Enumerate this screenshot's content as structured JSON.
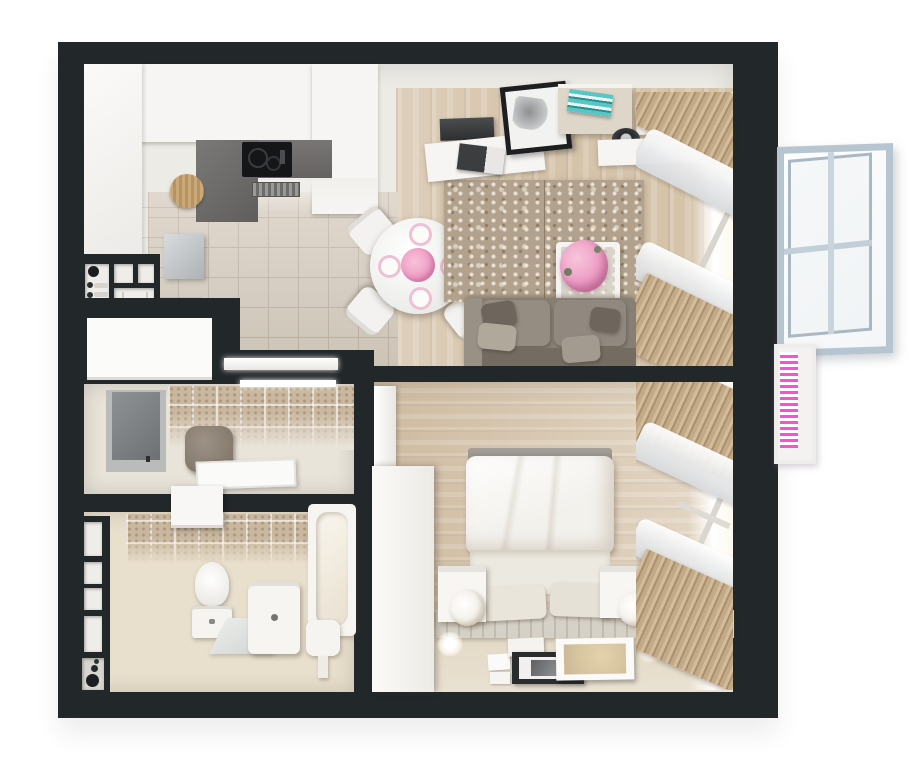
{
  "scene": {
    "type": "3d-floor-plan",
    "subject": "one-bedroom apartment, top-down 3D render",
    "background": "#ffffff",
    "wall_color": "#22272a"
  },
  "palette": {
    "wall": "#22272a",
    "wood_floor": "#d6c4ab",
    "tile_floor": "#d8cec1",
    "bath_floor": "#e9dfcd",
    "hall_floor": "#e9e4da",
    "wall_face": "#edebe6",
    "counter_gray": "#6d6c6a",
    "cooktop_black": "#151617",
    "sofa_gray": "#8d8478",
    "rug_beige": "#b2a28d",
    "curtain_tan": "#c3aa87",
    "sheer_white": "#f0f0f1",
    "window_frame_blue": "#b7c5d1",
    "radiator_pink": "#f553d2",
    "flower_pink": "#efaccb",
    "flower_white": "#faf8f4",
    "book_teal": "#56c7c4",
    "bed_white": "#f2efe9"
  },
  "rooms": {
    "kitchen": {
      "label": "kitchen",
      "items": [
        "upper-cabinets",
        "tall-cabinet",
        "counter",
        "induction-cooktop",
        "oven-vent",
        "fridge",
        "cutting-board",
        "tile-floor",
        "entry-shelf-unit",
        "door-slab"
      ]
    },
    "dining": {
      "label": "dining area",
      "items": [
        "round-table",
        "chair x4",
        "plate x4",
        "pink-flower-centerpiece"
      ]
    },
    "living": {
      "label": "living room",
      "items": [
        "sofa",
        "seat-cushions",
        "throw-pillows",
        "area-rug",
        "coffee-table",
        "pink-bouquet",
        "tv-panel",
        "wall-shelf",
        "picture-frame",
        "magazine",
        "floating-shelves",
        "teal-books",
        "decor-bowl",
        "tan-curtains",
        "sheer-shades",
        "window-radiator"
      ]
    },
    "hallway": {
      "label": "hallway",
      "items": [
        "tiled-wall",
        "storage-alcove",
        "pouf",
        "door-mat",
        "led-threshold"
      ]
    },
    "bathroom": {
      "label": "bathroom",
      "items": [
        "tiled-wall",
        "wall-niches",
        "washer-box",
        "toilet",
        "vanity-sink",
        "mirror-panel",
        "stool",
        "bathtub"
      ]
    },
    "bedroom": {
      "label": "bedroom",
      "items": [
        "wardrobe",
        "radiator-panel",
        "double-bed",
        "duvet",
        "pillow x2",
        "nightstand x2",
        "white-flower-bouquet x2",
        "slatted-runner",
        "leaning-frame-large",
        "leaning-frame-black",
        "leaning-frame-small",
        "cards",
        "wall-light x2",
        "tan-curtains",
        "sheer-shades"
      ]
    }
  },
  "exterior": {
    "items": [
      "open-casement-window",
      "pink-striped-radiator"
    ],
    "window_frame_color": "#b7c5d1",
    "radiator_stripe_color": "#f553d2"
  }
}
